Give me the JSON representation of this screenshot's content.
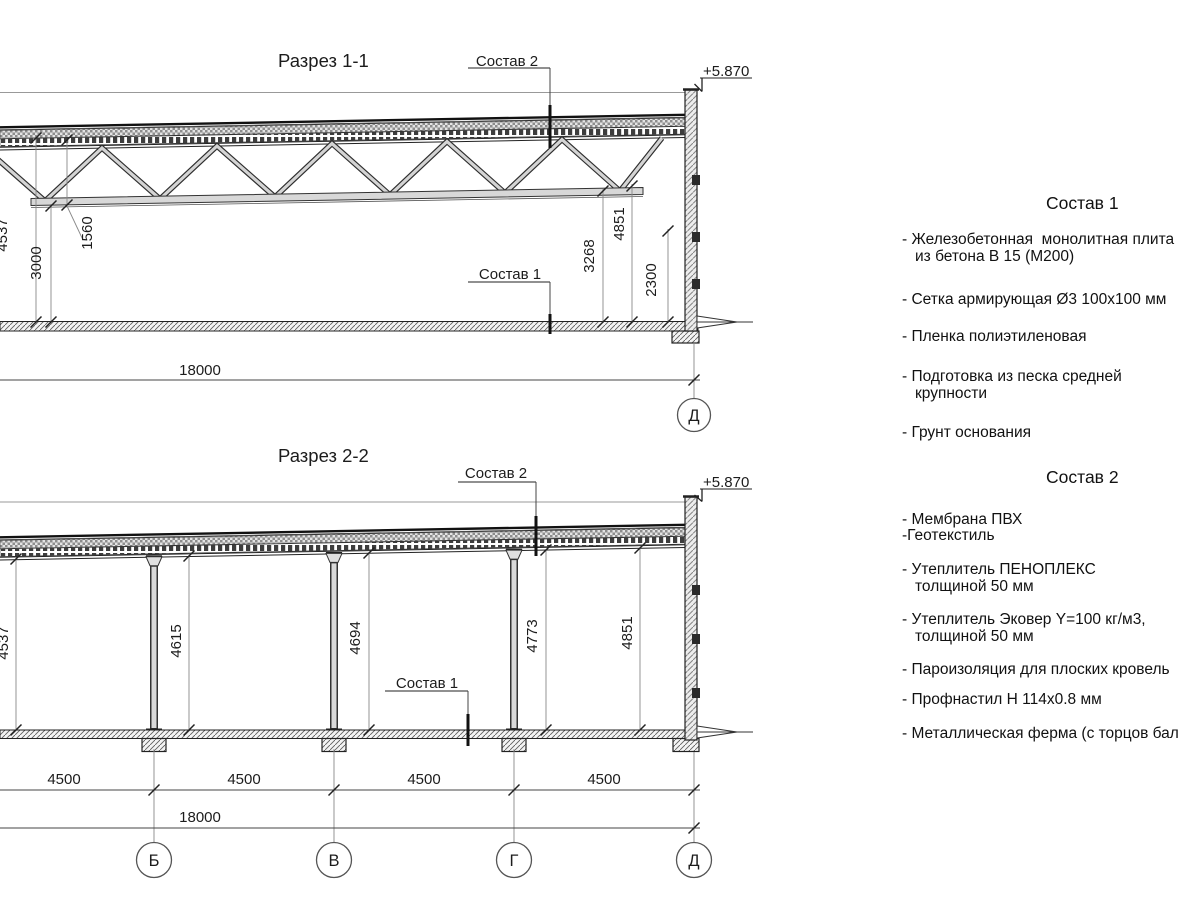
{
  "drawing1": {
    "title": "Разрез 1-1",
    "leader_roof": "Состав 2",
    "leader_floor": "Состав 1",
    "elevation": "+5.870",
    "dim_4537": "4537",
    "dim_3000": "3000",
    "dim_1560": "1560",
    "dim_3268": "3268",
    "dim_4851": "4851",
    "dim_2300": "2300",
    "dim_total": "18000",
    "axis_d": "Д"
  },
  "drawing2": {
    "title": "Разрез 2-2",
    "leader_roof": "Состав 2",
    "leader_floor": "Состав 1",
    "elevation": "+5.870",
    "heights": [
      "4537",
      "4615",
      "4694",
      "4773",
      "4851"
    ],
    "spans": [
      "4500",
      "4500",
      "4500",
      "4500"
    ],
    "dim_total": "18000",
    "axes": [
      "Б",
      "В",
      "Г",
      "Д"
    ]
  },
  "composition1": {
    "title": "Состав 1",
    "items": [
      "- Железобетонная  монолитная плита\nиз бетона В 15 (М200)",
      "- Сетка армирующая Ø3 100х100 мм",
      "- Пленка полиэтиленовая",
      "- Подготовка из песка средней\nкрупности",
      "- Грунт основания"
    ]
  },
  "composition2": {
    "title": "Состав 2",
    "items": [
      "- Мембрана ПВХ",
      "-Геотекстиль",
      "- Утеплитель ПЕНОПЛЕКС\nтолщиной 50 мм",
      "- Утеплитель Эковер Y=100 кг/м3,\nтолщиной 50 мм",
      "- Пароизоляция для плоских кровель",
      "- Профнастил Н 114х0.8 мм",
      "- Металлическая ферма (с торцов бал"
    ]
  }
}
